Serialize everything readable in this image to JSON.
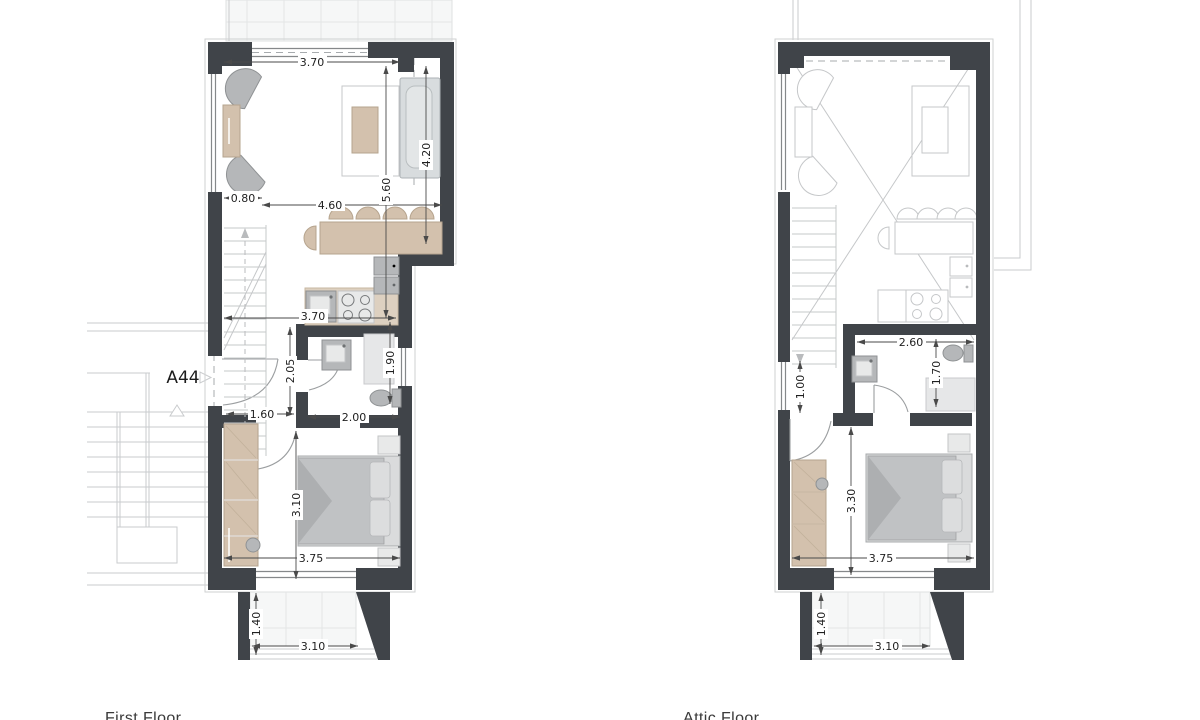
{
  "drawing": {
    "type": "architectural floor plans",
    "unit": {
      "label": "A44"
    },
    "palette": {
      "wall": "#404449",
      "wood": "#d3c1ad",
      "furniture_gray": "#b5b7b9",
      "context_line": "#c9cbcd",
      "dimension_line": "#4a4a4a",
      "text": "#1f1f1f"
    },
    "first_floor": {
      "name": "First Floor",
      "dims": {
        "top_width": "3.70",
        "niche_width": "0.80",
        "living_length": "4.60",
        "sofa_wall_length": "4.20",
        "living_depth": "5.60",
        "kitchen_width": "3.70",
        "hall_depth": "2.05",
        "bath_depth": "1.90",
        "hall_width": "1.60",
        "bath_width": "2.00",
        "bedroom_depth": "3.10",
        "bedroom_width": "3.75",
        "balcony_depth": "1.40",
        "balcony_width": "3.10"
      }
    },
    "attic_floor": {
      "name": "Attic Floor",
      "dims": {
        "bath_width": "2.60",
        "bath_depth": "1.70",
        "window_width": "1.00",
        "bedroom_depth": "3.30",
        "bedroom_width": "3.75",
        "balcony_depth": "1.40",
        "balcony_width": "3.10"
      }
    }
  }
}
